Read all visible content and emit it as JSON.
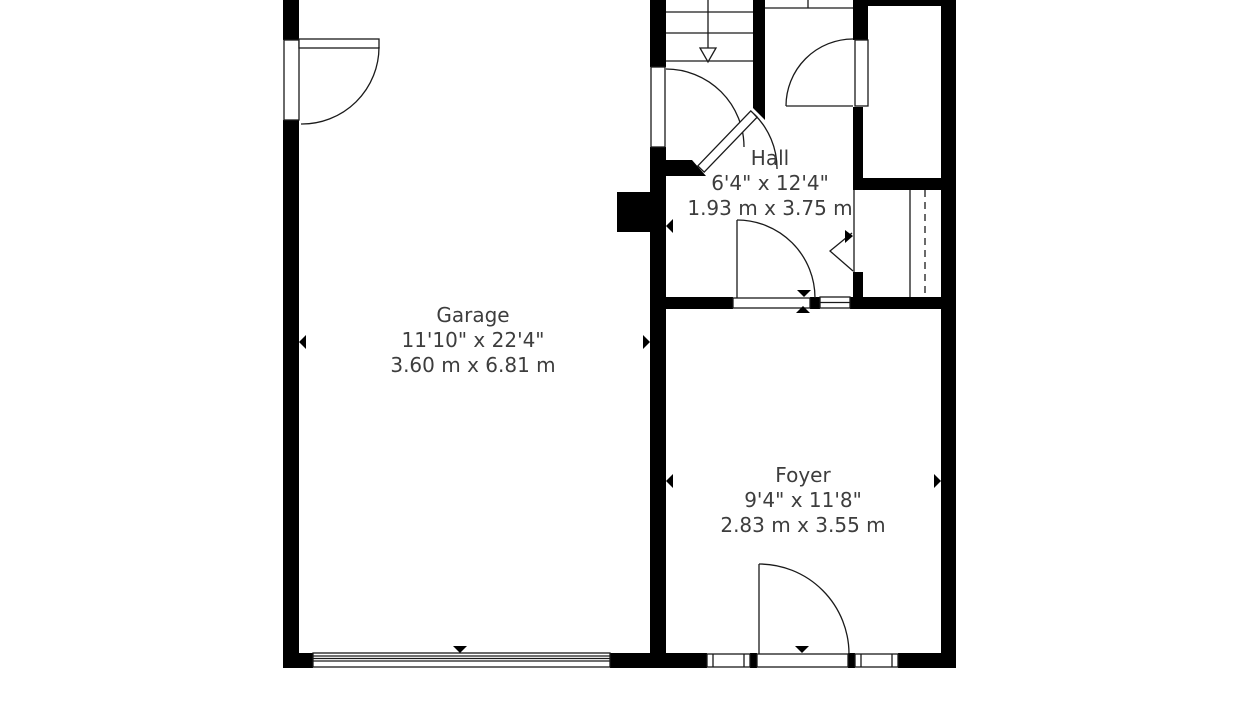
{
  "plan": {
    "title": "First floor partial plan",
    "rooms": [
      {
        "id": "garage",
        "name": "Garage",
        "imperial": "11'10\" x 22'4\"",
        "metric": "3.60 m x 6.81 m"
      },
      {
        "id": "hall",
        "name": "Hall",
        "imperial": "6'4\" x 12'4\"",
        "metric": "1.93 m x 3.75 m"
      },
      {
        "id": "foyer",
        "name": "Foyer",
        "imperial": "9'4\" x 11'8\"",
        "metric": "2.83 m x 3.55 m"
      }
    ],
    "colors": {
      "wall": "#000000",
      "background": "#ffffff",
      "text": "#3d3d3d"
    }
  }
}
